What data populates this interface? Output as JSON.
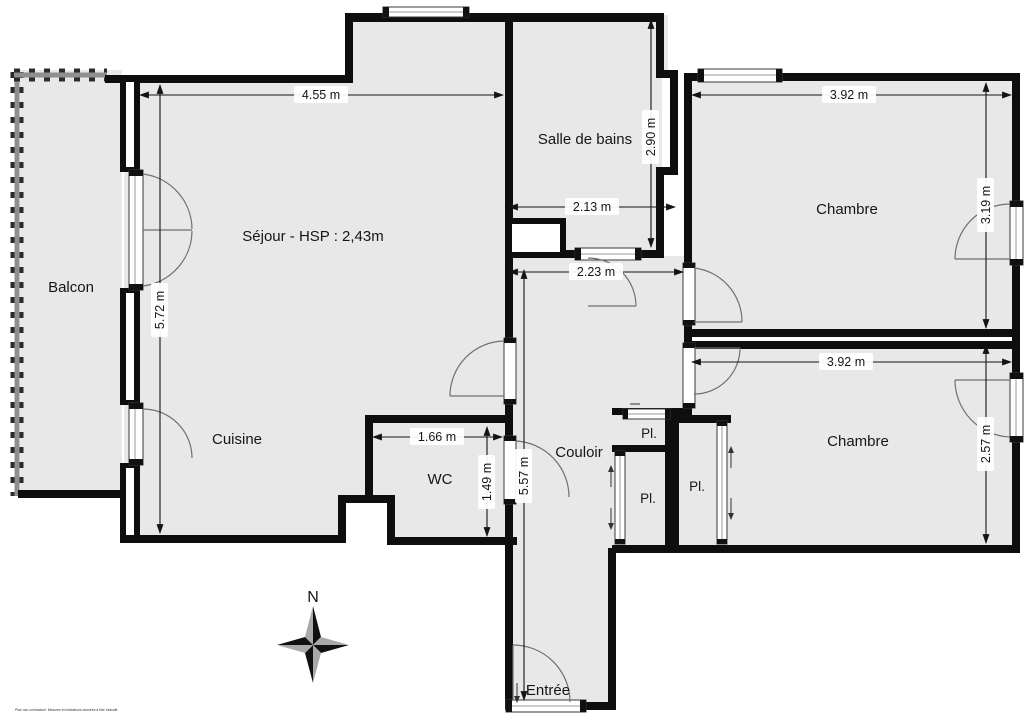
{
  "plan": {
    "rooms": {
      "balcon": "Balcon",
      "sejour": "Séjour - HSP : 2,43m",
      "cuisine": "Cuisine",
      "wc": "WC",
      "couloir": "Couloir",
      "salle_de_bains": "Salle de bains",
      "chambre_1": "Chambre",
      "chambre_2": "Chambre",
      "pl_top": "Pl.",
      "pl_left": "Pl.",
      "pl_right": "Pl.",
      "entree": "Entrée"
    },
    "dimensions": {
      "sejour_width": "4.55 m",
      "sejour_height": "5.72 m",
      "sdb_height": "2.90 m",
      "sdb_width": "2.13 m",
      "couloir_width": "2.23 m",
      "couloir_length": "5.57 m",
      "wc_width": "1.66 m",
      "wc_depth": "1.49 m",
      "chambre1_width": "3.92 m",
      "chambre1_depth": "3.19 m",
      "chambre2_width": "3.92 m",
      "chambre2_depth": "2.57 m"
    },
    "compass_north": "N",
    "disclaimer": "Plan non contractuel. Mesures et indications données à titre indicatif",
    "colors": {
      "floor": "#e8e8e8",
      "wall": "#0e0e0e",
      "window_stroke": "#3a3a3a",
      "door_arc": "#707070",
      "compass_dark": "#111111",
      "compass_light": "#a9a9a9",
      "background": "#ffffff"
    }
  }
}
